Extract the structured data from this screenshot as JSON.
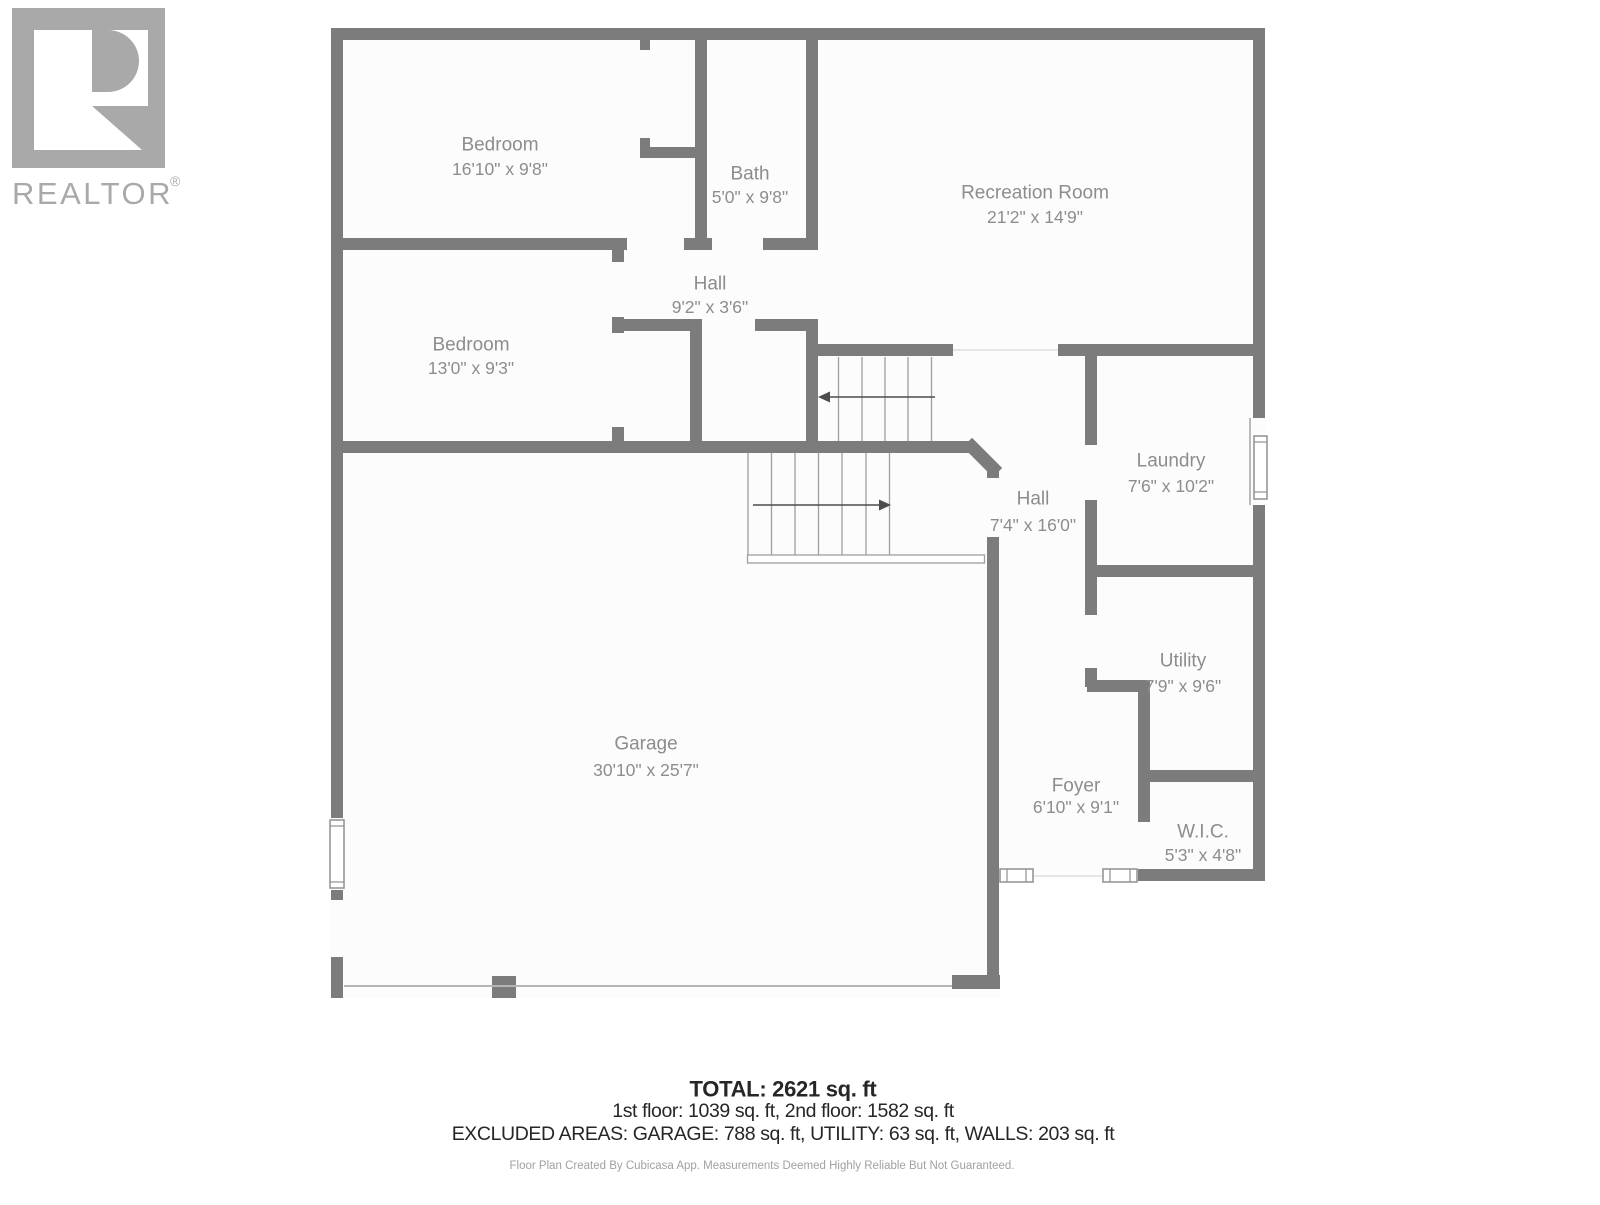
{
  "logo": {
    "brand": "REALTOR",
    "registered": "®"
  },
  "rooms": [
    {
      "id": "bedroom-1",
      "name": "Bedroom",
      "dims": "16'10\" x 9'8\""
    },
    {
      "id": "bath",
      "name": "Bath",
      "dims": "5'0\" x 9'8\""
    },
    {
      "id": "recreation-room",
      "name": "Recreation Room",
      "dims": "21'2\" x 14'9\""
    },
    {
      "id": "hall-upper",
      "name": "Hall",
      "dims": "9'2\" x 3'6\""
    },
    {
      "id": "bedroom-2",
      "name": "Bedroom",
      "dims": "13'0\" x 9'3\""
    },
    {
      "id": "laundry",
      "name": "Laundry",
      "dims": "7'6\" x 10'2\""
    },
    {
      "id": "hall-lower",
      "name": "Hall",
      "dims": "7'4\" x 16'0\""
    },
    {
      "id": "utility",
      "name": "Utility",
      "dims": "7'9\" x 9'6\""
    },
    {
      "id": "garage",
      "name": "Garage",
      "dims": "30'10\" x 25'7\""
    },
    {
      "id": "foyer",
      "name": "Foyer",
      "dims": "6'10\" x 9'1\""
    },
    {
      "id": "wic",
      "name": "W.I.C.",
      "dims": "5'3\" x 4'8\""
    }
  ],
  "summary": {
    "total": "TOTAL: 2621 sq. ft",
    "floors": "1st floor: 1039 sq. ft, 2nd floor: 1582 sq. ft",
    "excluded": "EXCLUDED AREAS: GARAGE: 788 sq. ft, UTILITY: 63 sq. ft, WALLS: 203 sq. ft"
  },
  "footer": "Floor Plan Created By Cubicasa App. Measurements Deemed Highly Reliable But Not Guaranteed.",
  "colors": {
    "wall": "#7c7c7c",
    "floor": "#fcfcfc",
    "room_label": "#8d8d8d",
    "stair_line": "#9e9e9e",
    "arrow": "#4d4d4d",
    "window_frame": "#909090",
    "opening_line": "#dddddd",
    "summary_text": "#262626",
    "footer_text": "#a1a1a1",
    "logo": "#a9a9a9"
  }
}
